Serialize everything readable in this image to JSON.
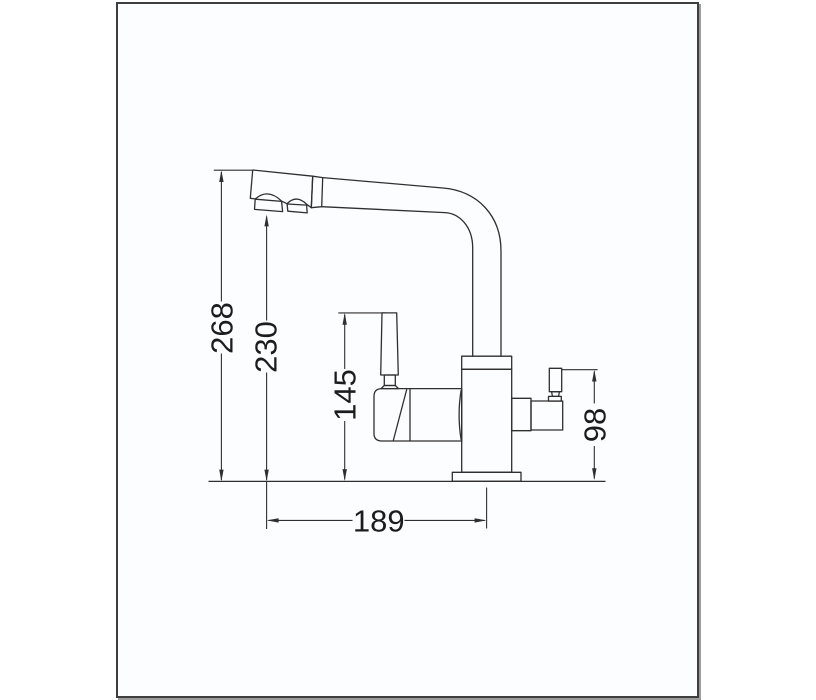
{
  "drawing": {
    "type": "technical-dimension-drawing",
    "subject": "kitchen faucet side view with dimension lines",
    "line_color": "#2f2f2f",
    "frame_border_color": "#3e3e3e",
    "frame_background": "#fcfdfe",
    "page_background": "#ffffff",
    "dimensions": {
      "overall_height": "268",
      "spout_outlet_height": "230",
      "lever_handle_height": "145",
      "filter_handle_height": "98",
      "base_width": "189"
    }
  }
}
